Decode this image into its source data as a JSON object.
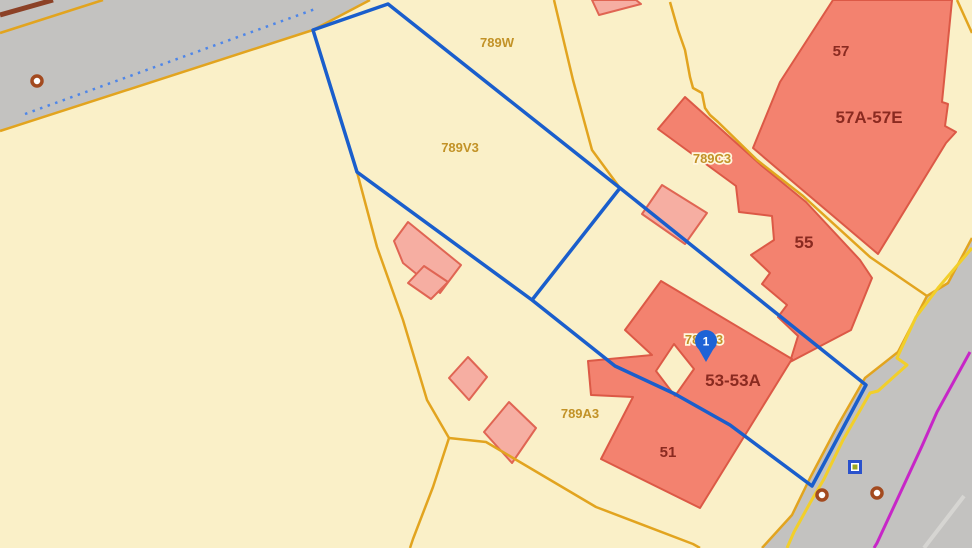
{
  "map": {
    "background_color": "#FAF0C8",
    "colors": {
      "road": "#C3C2C0",
      "parcel_line": "#E2A41F",
      "selection_line": "#1A5ECC",
      "dotted_line": "#4E86E8",
      "road_yellow_line": "#F2CF2A",
      "utility_magenta_line": "#C726C7",
      "building_fill": "#F3826F",
      "building_light_fill": "#F6AEA2",
      "parcel_label": "#C29227",
      "building_label": "#8A2A20",
      "pin": "#1E63D6"
    },
    "shapes": [
      {
        "kind": "polygon",
        "name": "road-top-left",
        "interactable": true,
        "cls": "road",
        "points": "0,0 370,0 313,30 0,131"
      },
      {
        "kind": "polygon",
        "name": "road-bottom-right",
        "interactable": true,
        "cls": "road",
        "points": "972,238 948,283 927,296 898,352 865,378 838,425 810,478 792,515 762,548 972,548"
      },
      {
        "kind": "polyline",
        "name": "road-edge-brown-line",
        "interactable": false,
        "cls": "l-brown",
        "points": "0,15 53,0"
      },
      {
        "kind": "polyline",
        "name": "road-edge-orange-segment",
        "interactable": false,
        "cls": "l-orange",
        "points": "0,33 103,0"
      },
      {
        "kind": "polyline",
        "name": "road-dotted-centerline",
        "interactable": false,
        "cls": "l-blue-dot",
        "points": "25,114 318,8"
      },
      {
        "kind": "polygon",
        "name": "building-57a-57e",
        "interactable": true,
        "cls": "bld-dark",
        "points": "833,0 952,0 942,102 948,104 945,126 956,132 946,143 878,254 753,148 780,82"
      },
      {
        "kind": "polygon",
        "name": "building-789c3-55",
        "interactable": true,
        "cls": "bld-dark",
        "points": "685,97 658,129 736,186 739,212 772,216 774,240 751,255 770,273 762,284 787,305 778,317 798,336 790,362 851,330 872,278 860,260 806,202 762,166"
      },
      {
        "kind": "path",
        "name": "building-51-53-53a",
        "interactable": true,
        "cls": "bld-dark",
        "d": "M661,281 L792,359 L700,508 L601,459 L633,397 L591,395 L588,361 L652,355 L625,330 Z M674,344 L694,369 L675,396 L656,371 Z",
        "fillrule": "evenodd"
      },
      {
        "kind": "polygon",
        "name": "building-789v3-shed",
        "interactable": true,
        "cls": "bld-light",
        "points": "408,222 394,241 403,263 440,293 461,265"
      },
      {
        "kind": "polygon",
        "name": "building-789c3-shed",
        "interactable": true,
        "cls": "bld-light",
        "points": "662,185 707,213 685,244 642,214"
      },
      {
        "kind": "polygon",
        "name": "building-789w-top",
        "interactable": true,
        "cls": "bld-light",
        "points": "592,0 599,15 641,4 636,0"
      },
      {
        "kind": "polygon",
        "name": "building-789a3-shed-1",
        "interactable": true,
        "cls": "bld-light",
        "points": "424,266 448,282 431,299 408,283"
      },
      {
        "kind": "polygon",
        "name": "building-789a3-shed-2",
        "interactable": true,
        "cls": "bld-light",
        "points": "468,357 487,377 469,400 449,378"
      },
      {
        "kind": "polygon",
        "name": "building-789a3-shed-3",
        "interactable": true,
        "cls": "bld-light",
        "points": "509,402 536,428 512,463 484,432"
      },
      {
        "kind": "polyline",
        "name": "parcel-line-road-edge-top",
        "interactable": false,
        "cls": "l-orange",
        "points": "0,131 313,30 370,0"
      },
      {
        "kind": "polyline",
        "name": "parcel-line-789w-east",
        "interactable": false,
        "cls": "l-orange",
        "points": "554,0 573,80 592,150 620,188"
      },
      {
        "kind": "polyline",
        "name": "parcel-line-789c3-57",
        "interactable": false,
        "cls": "l-orange",
        "points": "670,2 678,30 685,50 690,77 693,88 702,93 705,108 710,115 718,122 757,160 803,196 870,257 905,281 927,296"
      },
      {
        "kind": "polyline",
        "name": "parcel-line-789v3-789a3",
        "interactable": false,
        "cls": "l-orange",
        "points": "357,172 377,247 403,320 427,400 449,438"
      },
      {
        "kind": "polyline",
        "name": "parcel-line-789a3-southwest",
        "interactable": false,
        "cls": "l-orange",
        "points": "449,438 433,487 413,539 410,548"
      },
      {
        "kind": "polyline",
        "name": "parcel-line-789a3-south",
        "interactable": false,
        "cls": "l-orange",
        "points": "449,438 486,442 596,507 693,544 700,548"
      },
      {
        "kind": "polyline",
        "name": "parcel-line-road-edge-right",
        "interactable": false,
        "cls": "l-orange",
        "points": "972,238 948,283 927,296 898,352 865,378 838,425 810,478 792,515 762,548"
      },
      {
        "kind": "polyline",
        "name": "parcel-line-top-right-corner",
        "interactable": false,
        "cls": "l-orange",
        "points": "957,0 972,33"
      },
      {
        "kind": "polyline",
        "name": "road-yellow-edge-line",
        "interactable": false,
        "cls": "l-yellow",
        "points": "972,248 938,288 916,317 897,358 907,365 878,391 870,393 843,440 824,479 810,503 794,532 787,548"
      },
      {
        "kind": "polyline",
        "name": "utility-magenta-line",
        "interactable": false,
        "cls": "l-magenta",
        "points": "970,352 937,412 922,446 877,543 874,548"
      },
      {
        "kind": "polyline",
        "name": "road-lane-stripe",
        "interactable": false,
        "cls": "l-stripe",
        "points": "964,496 924,548"
      },
      {
        "kind": "polygon",
        "name": "selected-parcel-outline",
        "interactable": true,
        "cls": "l-blue",
        "points": "388,4 620,188 866,385 812,486 730,425 675,394 615,366 532,300 357,172 313,30"
      },
      {
        "kind": "polyline",
        "name": "selected-parcel-divider",
        "interactable": false,
        "cls": "l-blue",
        "points": "620,188 532,300"
      },
      {
        "kind": "circle",
        "name": "survey-marker-ring-1",
        "interactable": true,
        "cls": "ring",
        "x": 37,
        "y": 81,
        "r": 5
      },
      {
        "kind": "circle",
        "name": "survey-marker-ring-2",
        "interactable": true,
        "cls": "ring",
        "x": 822,
        "y": 495,
        "r": 5
      },
      {
        "kind": "circle",
        "name": "survey-marker-ring-3",
        "interactable": true,
        "cls": "ring",
        "x": 877,
        "y": 493,
        "r": 5
      },
      {
        "kind": "sqmarker",
        "name": "survey-marker-square",
        "interactable": true,
        "x": 855,
        "y": 467,
        "outer": 14,
        "mid": 8,
        "inner": 5,
        "outer_color": "#2A52CC",
        "mid_color": "#FFFFFF",
        "inner_color": "#9CA821"
      },
      {
        "kind": "text",
        "name": "parcel-label-789w",
        "interactable": false,
        "cls": "lbl-parcel",
        "text": "789W",
        "x": 497,
        "y": 47
      },
      {
        "kind": "text",
        "name": "parcel-label-789v3",
        "interactable": false,
        "cls": "lbl-parcel",
        "text": "789V3",
        "x": 460,
        "y": 152
      },
      {
        "kind": "text",
        "name": "parcel-label-789c3",
        "interactable": false,
        "cls": "lbl-parcel halo",
        "text": "789C3",
        "x": 712,
        "y": 163
      },
      {
        "kind": "text",
        "name": "parcel-label-789b3",
        "interactable": false,
        "cls": "lbl-parcel halo",
        "text": "789B3",
        "x": 704,
        "y": 344
      },
      {
        "kind": "text",
        "name": "parcel-label-789a3",
        "interactable": false,
        "cls": "lbl-parcel",
        "text": "789A3",
        "x": 580,
        "y": 418
      },
      {
        "kind": "text",
        "name": "building-label-57",
        "interactable": false,
        "cls": "lbl-bld-sm",
        "text": "57",
        "x": 841,
        "y": 56
      },
      {
        "kind": "text",
        "name": "building-label-57a-57e",
        "interactable": false,
        "cls": "lbl-bld",
        "text": "57A-57E",
        "x": 869,
        "y": 123
      },
      {
        "kind": "text",
        "name": "building-label-55",
        "interactable": false,
        "cls": "lbl-bld",
        "text": "55",
        "x": 804,
        "y": 248
      },
      {
        "kind": "text",
        "name": "building-label-53-53a",
        "interactable": false,
        "cls": "lbl-bld",
        "text": "53-53A",
        "x": 733,
        "y": 386
      },
      {
        "kind": "text",
        "name": "building-label-51",
        "interactable": false,
        "cls": "lbl-bld-sm",
        "text": "51",
        "x": 668,
        "y": 457
      },
      {
        "kind": "pin",
        "name": "map-pin-1",
        "interactable": true,
        "x": 706,
        "y": 341,
        "tip_y": 362,
        "r": 11,
        "text": "1"
      }
    ]
  }
}
